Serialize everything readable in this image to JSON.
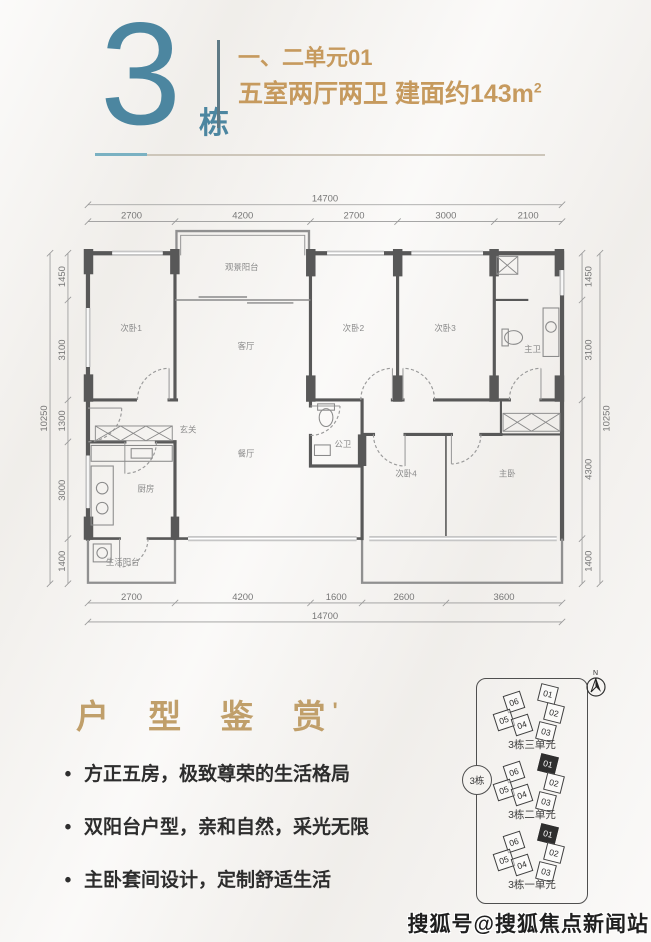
{
  "header": {
    "building_number": "3",
    "building_suffix": "栋",
    "unit_line": "一、二单元01",
    "spec_line": "五室两厅两卫 建面约143m",
    "spec_sup": "2"
  },
  "section": {
    "title": "户 型 鉴 赏",
    "title_mark": "'"
  },
  "bullets": [
    "方正五房，极致尊荣的生活格局",
    "双阳台户型，亲和自然，采光无限",
    "主卧套间设计，定制舒适生活"
  ],
  "floorplan": {
    "rooms": {
      "bedroom1": "次卧1",
      "view_balcony": "观景阳台",
      "living": "客厅",
      "bedroom2": "次卧2",
      "bedroom3": "次卧3",
      "master_bath": "主卫",
      "foyer": "玄关",
      "dining": "餐厅",
      "kitchen": "厨房",
      "service_balcony": "生活阳台",
      "guest_bath": "公卫",
      "bedroom4": "次卧4",
      "master_bedroom": "主卧"
    },
    "top_total": "14700",
    "top_segments": [
      "2700",
      "4200",
      "2700",
      "3000",
      "2100"
    ],
    "bottom_segments": [
      "2700",
      "4200",
      "1600",
      "2600",
      "3600"
    ],
    "bottom_total": "14700",
    "left_segments": [
      "1450",
      "3100",
      "1300",
      "3000",
      "1400"
    ],
    "left_total": "10250",
    "right_segments": [
      "1450",
      "3100",
      "4300",
      "1400"
    ],
    "right_total": "10250"
  },
  "minimap": {
    "building_badge": "3栋",
    "compass_label": "N",
    "clusters": [
      {
        "label": "3栋三单元",
        "units": [
          "06",
          "01",
          "05",
          "04",
          "02",
          "03"
        ],
        "highlight": ""
      },
      {
        "label": "3栋二单元",
        "units": [
          "06",
          "01",
          "05",
          "04",
          "02",
          "03"
        ],
        "highlight": "01"
      },
      {
        "label": "3栋一单元",
        "units": [
          "06",
          "01",
          "05",
          "04",
          "02",
          "03"
        ],
        "highlight": "01"
      }
    ]
  },
  "watermark": "搜狐号@搜狐焦点新闻站",
  "colors": {
    "teal": "#4c86a0",
    "tan": "#c69a5e",
    "title_tan": "#c09f6a",
    "wall": "#585858"
  }
}
